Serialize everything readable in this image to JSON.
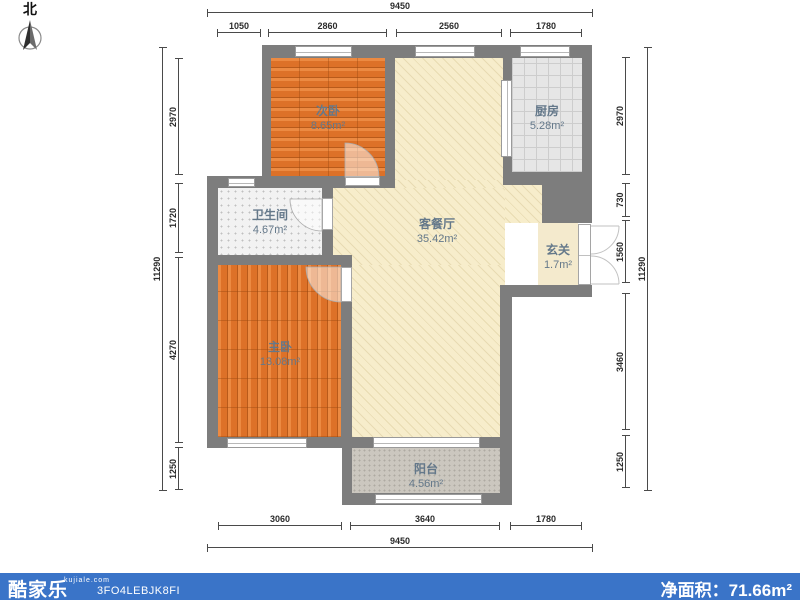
{
  "compass": {
    "label": "北"
  },
  "rooms": [
    {
      "name": "次卧",
      "area": "8.65m²"
    },
    {
      "name": "厨房",
      "area": "5.28m²"
    },
    {
      "name": "卫生间",
      "area": "4.67m²"
    },
    {
      "name": "客餐厅",
      "area": "35.42m²"
    },
    {
      "name": "玄关",
      "area": "1.7m²"
    },
    {
      "name": "主卧",
      "area": "13.08m²"
    },
    {
      "name": "阳台",
      "area": "4.56m²"
    }
  ],
  "dimensions": {
    "top": {
      "total": "9450",
      "segments": [
        "1050",
        "2860",
        "2560",
        "1780"
      ]
    },
    "bottom": {
      "total": "9450",
      "segments": [
        "3060",
        "3640",
        "1780"
      ]
    },
    "left": {
      "total": "11290",
      "segments": [
        "2970",
        "1720",
        "4270",
        "1250"
      ]
    },
    "right": {
      "total": "11290",
      "segments": [
        "2970",
        "730",
        "1560",
        "3460",
        "1250"
      ]
    }
  },
  "footer": {
    "logo": "酷家乐",
    "site": "kujiale.com",
    "code": "3FO4LEBJK8FI",
    "net_area_label": "净面积：",
    "net_area_value": "71.66m²"
  },
  "colors": {
    "footer_bar": "#3a74c8",
    "wall": "#7d7d7d",
    "wood_floor": "#dd7128",
    "living_floor": "#f7edcb",
    "kitchen_floor": "#e6e6e6",
    "balcony_floor": "#cbc7bf"
  }
}
